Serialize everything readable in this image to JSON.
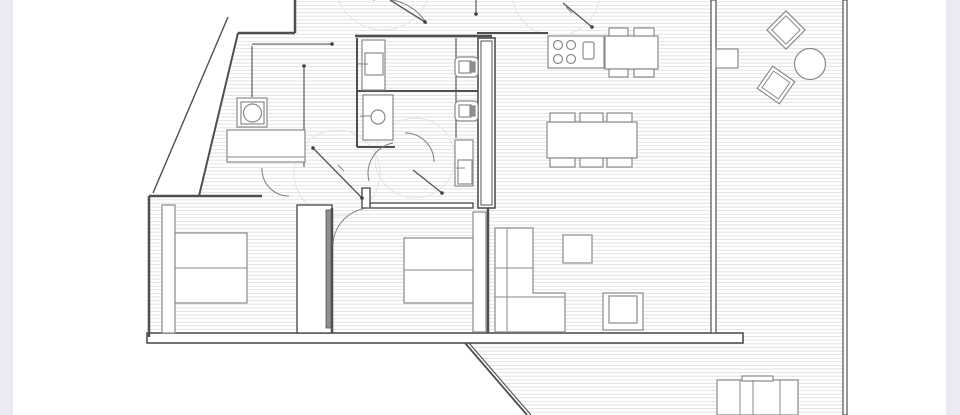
{
  "canvas": {
    "width": 960,
    "height": 415
  },
  "colors": {
    "background": "#ffffff",
    "edge_strip": "#e9eaf2",
    "wall": "#4f4f4f",
    "thin": "#7d7d7d",
    "furniture": "#8a8a8a",
    "hatch": "#dadada",
    "faint": "#e4e4e4",
    "dark_fill": "#8f8f8f",
    "dot": "#3f3f3f"
  },
  "edge_strips": [
    {
      "n": "left-page-edge",
      "x": 0,
      "y": 0,
      "w": 13,
      "h": 415
    },
    {
      "n": "right-page-edge",
      "x": 946,
      "y": 0,
      "w": 14,
      "h": 415
    }
  ],
  "floorplan": {
    "hatch_regions": [
      {
        "n": "main-floor-area",
        "points": "295,0 713,0 713,333 147,333 147,196 199,196 240,33 295,33"
      },
      {
        "n": "terrace-floor-area",
        "points": "716,0 843,0 843,415 527,415 465,343 743,343 743,333 716,333"
      }
    ],
    "swing_circles": [
      {
        "n": "door-swing-hall-left",
        "cx": 337,
        "cy": 173,
        "r": 43
      },
      {
        "n": "door-swing-hall-right",
        "cx": 415,
        "cy": 158,
        "r": 40
      },
      {
        "n": "door-swing-kitchen",
        "cx": 556,
        "cy": -8,
        "r": 44
      },
      {
        "n": "door-swing-top-entry",
        "cx": 383,
        "cy": -18,
        "r": 48
      }
    ],
    "wall_rects": [
      {
        "n": "bottom-wall-band",
        "x": 147,
        "y": 333,
        "w": 596,
        "h": 10,
        "sw": 1.6
      },
      {
        "n": "living-terrace-wall",
        "x": 711,
        "y": 0,
        "w": 5,
        "h": 333,
        "sw": 1.2
      },
      {
        "n": "terrace-right-wall",
        "x": 843,
        "y": 0,
        "w": 4,
        "h": 415,
        "sw": 1.2
      },
      {
        "n": "service-shaft-outer",
        "x": 478,
        "y": 38,
        "w": 17,
        "h": 170,
        "sw": 1.6
      },
      {
        "n": "service-shaft-inner",
        "x": 481,
        "y": 41,
        "w": 11,
        "h": 164,
        "sw": 1
      },
      {
        "n": "midbedroom-top-wall",
        "x": 370,
        "y": 203,
        "w": 103,
        "h": 5,
        "sw": 1.4
      },
      {
        "n": "hall-wall-chunk",
        "x": 362,
        "y": 188,
        "w": 8,
        "h": 20,
        "sw": 1.4
      },
      {
        "n": "wardrobe-bedroom-left",
        "x": 297,
        "y": 205,
        "w": 35,
        "h": 128,
        "sw": 1.4
      },
      {
        "n": "wardrobe-door-strip",
        "x": 326,
        "y": 210,
        "w": 6,
        "h": 118,
        "sw": 0.8,
        "fill": "dark"
      }
    ],
    "wall_lines": [
      {
        "n": "top-left-outer-wall-v",
        "x1": 295,
        "y1": 0,
        "x2": 295,
        "y2": 33,
        "w": 2.5
      },
      {
        "n": "top-left-outer-wall-h",
        "x1": 238,
        "y1": 33,
        "x2": 295,
        "y2": 33,
        "w": 2.5
      },
      {
        "n": "angled-wall-inner",
        "x1": 238,
        "y1": 33,
        "x2": 199,
        "y2": 196,
        "w": 2
      },
      {
        "n": "angled-wall-outer",
        "x1": 228,
        "y1": 17,
        "x2": 153,
        "y2": 193,
        "w": 1.4
      },
      {
        "n": "bedroom-left-top-wall",
        "x1": 149,
        "y1": 196,
        "x2": 262,
        "y2": 196,
        "w": 2.5
      },
      {
        "n": "bedroom-left-left-wall",
        "x1": 149,
        "y1": 196,
        "x2": 149,
        "y2": 337,
        "w": 2.5
      },
      {
        "n": "bathroom-top-wall",
        "x1": 355,
        "y1": 36,
        "x2": 492,
        "y2": 36,
        "w": 2.5
      },
      {
        "n": "bathroom-left-wall",
        "x1": 357,
        "y1": 38,
        "x2": 357,
        "y2": 147,
        "w": 2
      },
      {
        "n": "bathroom-divider-wall",
        "x1": 357,
        "y1": 91,
        "x2": 478,
        "y2": 91,
        "w": 2
      },
      {
        "n": "bathroom2-bottom-wall",
        "x1": 357,
        "y1": 147,
        "x2": 395,
        "y2": 147,
        "w": 2
      },
      {
        "n": "bathroom-inner-right",
        "x1": 456,
        "y1": 38,
        "x2": 456,
        "y2": 138,
        "w": 1.1
      },
      {
        "n": "kitchen-top-wall",
        "x1": 477,
        "y1": 33,
        "x2": 548,
        "y2": 33,
        "w": 2
      },
      {
        "n": "midbedroom-left-wall",
        "x1": 332,
        "y1": 208,
        "x2": 332,
        "y2": 333,
        "w": 2.5
      },
      {
        "n": "midbedroom-right-wall",
        "x1": 488,
        "y1": 208,
        "x2": 488,
        "y2": 333,
        "w": 2.5
      },
      {
        "n": "laundry-counter-top",
        "x1": 252,
        "y1": 44,
        "x2": 332,
        "y2": 44,
        "w": 1.1
      },
      {
        "n": "laundry-screen-v",
        "x1": 252,
        "y1": 46,
        "x2": 252,
        "y2": 97,
        "w": 1.1
      },
      {
        "n": "laundry-post-line",
        "x1": 304,
        "y1": 66,
        "x2": 304,
        "y2": 167,
        "w": 1.1
      },
      {
        "n": "terrace-diagonal-outer",
        "x1": 465,
        "y1": 343,
        "x2": 527,
        "y2": 415,
        "w": 1.8
      },
      {
        "n": "terrace-diagonal-inner",
        "x1": 469,
        "y1": 343,
        "x2": 531,
        "y2": 415,
        "w": 1.1
      },
      {
        "n": "wall-tick-top",
        "x1": 476,
        "y1": 0,
        "x2": 476,
        "y2": 14,
        "w": 1.1
      }
    ],
    "furniture_rects": [
      {
        "n": "bed-left-headboard",
        "x": 162,
        "y": 205,
        "w": 13,
        "h": 128
      },
      {
        "n": "bed-left",
        "x": 175,
        "y": 233,
        "w": 72,
        "h": 70
      },
      {
        "n": "bed-mid-headboard",
        "x": 473,
        "y": 212,
        "w": 13,
        "h": 120
      },
      {
        "n": "bed-mid",
        "x": 404,
        "y": 238,
        "w": 69,
        "h": 65
      },
      {
        "n": "washing-machine-outer",
        "x": 237,
        "y": 98,
        "w": 30,
        "h": 29
      },
      {
        "n": "washing-machine-inner",
        "x": 241,
        "y": 102,
        "w": 23,
        "h": 22
      },
      {
        "n": "laundry-counter",
        "x": 227,
        "y": 130,
        "w": 78,
        "h": 32
      },
      {
        "n": "coffee-table",
        "x": 563,
        "y": 235,
        "w": 29,
        "h": 28
      },
      {
        "n": "armchair-outer",
        "x": 603,
        "y": 293,
        "w": 40,
        "h": 37
      },
      {
        "n": "armchair-inner",
        "x": 609,
        "y": 296,
        "w": 28,
        "h": 27
      },
      {
        "n": "dining-table",
        "x": 547,
        "y": 122,
        "w": 90,
        "h": 36
      },
      {
        "n": "dining-chair-1",
        "x": 550,
        "y": 113,
        "w": 25,
        "h": 9
      },
      {
        "n": "dining-chair-2",
        "x": 580,
        "y": 113,
        "w": 23,
        "h": 9
      },
      {
        "n": "dining-chair-3",
        "x": 607,
        "y": 113,
        "w": 25,
        "h": 9
      },
      {
        "n": "dining-chair-4",
        "x": 550,
        "y": 158,
        "w": 25,
        "h": 9
      },
      {
        "n": "dining-chair-5",
        "x": 580,
        "y": 158,
        "w": 23,
        "h": 9
      },
      {
        "n": "dining-chair-6",
        "x": 607,
        "y": 158,
        "w": 25,
        "h": 9
      },
      {
        "n": "kitchen-counter",
        "x": 548,
        "y": 36,
        "w": 56,
        "h": 32
      },
      {
        "n": "kitchen-sink",
        "x": 583,
        "y": 42,
        "w": 11,
        "h": 17,
        "rx": 2
      },
      {
        "n": "kitchen-island",
        "x": 605,
        "y": 36,
        "w": 53,
        "h": 33
      },
      {
        "n": "island-chair-1",
        "x": 609,
        "y": 28,
        "w": 19,
        "h": 8
      },
      {
        "n": "island-chair-2",
        "x": 634,
        "y": 28,
        "w": 20,
        "h": 8
      },
      {
        "n": "island-chair-3",
        "x": 609,
        "y": 69,
        "w": 19,
        "h": 8
      },
      {
        "n": "island-chair-4",
        "x": 634,
        "y": 69,
        "w": 20,
        "h": 8
      },
      {
        "n": "toilet-1-outer",
        "x": 455,
        "y": 57,
        "w": 23,
        "h": 20,
        "rx": 4
      },
      {
        "n": "toilet-1-inner",
        "x": 459,
        "y": 61,
        "w": 12,
        "h": 12
      },
      {
        "n": "toilet-1-tank",
        "x": 470,
        "y": 62,
        "w": 5,
        "h": 10,
        "fill": "dark"
      },
      {
        "n": "toilet-2-outer",
        "x": 455,
        "y": 101,
        "w": 23,
        "h": 20,
        "rx": 4
      },
      {
        "n": "toilet-2-inner",
        "x": 459,
        "y": 105,
        "w": 12,
        "h": 12
      },
      {
        "n": "toilet-2-tank",
        "x": 470,
        "y": 106,
        "w": 5,
        "h": 10,
        "fill": "dark"
      },
      {
        "n": "bath1-sink-cabinet",
        "x": 362,
        "y": 40,
        "w": 23,
        "h": 50
      },
      {
        "n": "bath1-sink-basin",
        "x": 365,
        "y": 53,
        "w": 18,
        "h": 22
      },
      {
        "n": "bath2-sink-cabinet",
        "x": 363,
        "y": 95,
        "w": 30,
        "h": 45
      },
      {
        "n": "shower-outer",
        "x": 455,
        "y": 140,
        "w": 18,
        "h": 46
      },
      {
        "n": "shower-inner",
        "x": 458,
        "y": 160,
        "w": 14,
        "h": 24
      },
      {
        "n": "terrace-side-table",
        "x": 716,
        "y": 49,
        "w": 22,
        "h": 19
      },
      {
        "n": "sun-lounger",
        "x": 717,
        "y": 380,
        "w": 81,
        "h": 35
      },
      {
        "n": "sun-lounger-headrest",
        "x": 742,
        "y": 376,
        "w": 31,
        "h": 5
      }
    ],
    "furniture_polygons": [
      {
        "n": "l-shaped-sofa",
        "points": "495,228 533,228 533,293 565,293 565,332 495,332"
      }
    ],
    "furniture_lines": [
      {
        "n": "bed-left-divider",
        "x1": 175,
        "y1": 268,
        "x2": 247,
        "y2": 268
      },
      {
        "n": "bed-mid-divider",
        "x1": 404,
        "y1": 270,
        "x2": 473,
        "y2": 270
      },
      {
        "n": "sofa-back-line",
        "x1": 507,
        "y1": 228,
        "x2": 507,
        "y2": 332
      },
      {
        "n": "sofa-cushion-line-1",
        "x1": 495,
        "y1": 268,
        "x2": 533,
        "y2": 268
      },
      {
        "n": "sofa-cushion-line-2",
        "x1": 495,
        "y1": 297,
        "x2": 565,
        "y2": 297
      },
      {
        "n": "counter-edge-line",
        "x1": 227,
        "y1": 157,
        "x2": 305,
        "y2": 157
      },
      {
        "n": "bath1-faucet-tick",
        "x1": 358,
        "y1": 64,
        "x2": 368,
        "y2": 64
      },
      {
        "n": "bath2-faucet-tick",
        "x1": 360,
        "y1": 116,
        "x2": 371,
        "y2": 116
      },
      {
        "n": "shower-faucet-tick",
        "x1": 456,
        "y1": 168,
        "x2": 465,
        "y2": 168
      },
      {
        "n": "lounger-divider-1",
        "x1": 740,
        "y1": 380,
        "x2": 740,
        "y2": 415
      },
      {
        "n": "lounger-divider-2",
        "x1": 753,
        "y1": 380,
        "x2": 753,
        "y2": 415
      },
      {
        "n": "lounger-divider-3",
        "x1": 780,
        "y1": 380,
        "x2": 780,
        "y2": 415
      },
      {
        "n": "door-label-squiggle-1",
        "x1": 338,
        "y1": 165,
        "x2": 344,
        "y2": 171
      },
      {
        "n": "door-label-squiggle-2",
        "x1": 566,
        "y1": 7,
        "x2": 572,
        "y2": 13
      }
    ],
    "circles": [
      {
        "n": "washer-drum",
        "cx": 252.5,
        "cy": 113,
        "r": 9
      },
      {
        "n": "bath2-basin",
        "cx": 378,
        "cy": 117,
        "r": 7
      },
      {
        "n": "terrace-round-table",
        "cx": 810,
        "cy": 64,
        "r": 15.5
      },
      {
        "n": "burner-1",
        "cx": 558,
        "cy": 45,
        "r": 4.5
      },
      {
        "n": "burner-2",
        "cx": 571,
        "cy": 45,
        "r": 4.5
      },
      {
        "n": "burner-3",
        "cx": 558,
        "cy": 59,
        "r": 4.5
      },
      {
        "n": "burner-4",
        "cx": 571,
        "cy": 59,
        "r": 4.5
      }
    ],
    "diamonds": [
      {
        "n": "terrace-chair-1",
        "cx": 786,
        "cy": 30,
        "size": 27,
        "rot": 45
      },
      {
        "n": "terrace-chair-2",
        "cx": 776,
        "cy": 85,
        "size": 27,
        "rot": 35
      }
    ],
    "door_arcs": [
      {
        "n": "bedroom-left-door-arc",
        "d": "M 262,168 A 27 27 0 0 0 289,196"
      },
      {
        "n": "bedroom-mid-door-arc",
        "d": "M 333,246 A 38 38 0 0 1 371,208"
      },
      {
        "n": "bathroom1-door-arc",
        "d": "M 405,133 A 29 29 0 0 1 434,162"
      },
      {
        "n": "bathroom2-door-arc",
        "d": "M 393,143 A 31 31 0 0 0 369,181"
      },
      {
        "n": "entry-door-arc",
        "d": "M 373,0 A 52 52 0 0 1 427,24"
      }
    ],
    "door_leaves": [
      {
        "n": "hall-door-leaf-left",
        "x1": 313,
        "y1": 148,
        "x2": 362,
        "y2": 198,
        "dots": [
          [
            313,
            148
          ],
          [
            362,
            198
          ]
        ]
      },
      {
        "n": "hall-door-leaf-right",
        "x1": 413,
        "y1": 170,
        "x2": 442,
        "y2": 193,
        "dots": [
          [
            442,
            193
          ]
        ]
      },
      {
        "n": "kitchen-door-leaf",
        "x1": 563,
        "y1": 3,
        "x2": 592,
        "y2": 27,
        "dots": [
          [
            592,
            27
          ]
        ]
      },
      {
        "n": "entry-door-leaf",
        "x1": 390,
        "y1": 0,
        "x2": 425,
        "y2": 22,
        "dots": [
          [
            425,
            22
          ]
        ]
      }
    ],
    "dots": [
      {
        "n": "wall-end-dot-1",
        "x": 332,
        "y": 44
      },
      {
        "n": "wall-end-dot-2",
        "x": 304,
        "y": 66
      },
      {
        "n": "wall-end-dot-3",
        "x": 476,
        "y": 14
      }
    ]
  }
}
